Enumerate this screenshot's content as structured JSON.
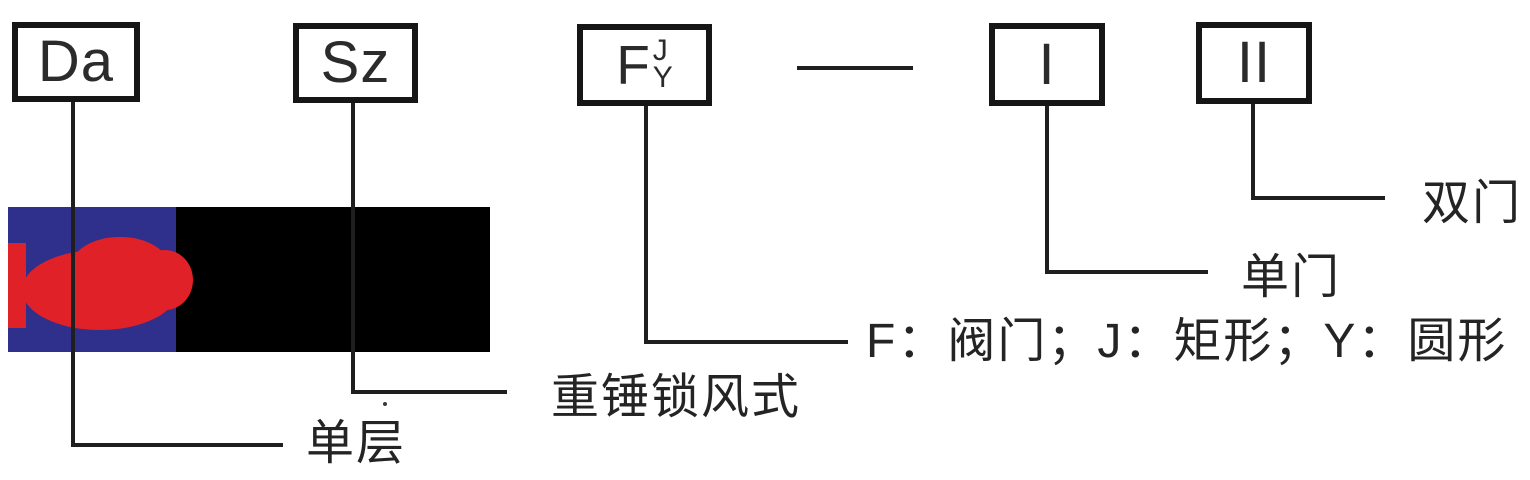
{
  "diagram": {
    "kind": "model-designation-diagram",
    "boxes": [
      {
        "id": "da",
        "code": "Da",
        "annotation": "单层"
      },
      {
        "id": "sz",
        "code": "Sz",
        "annotation": "重锤锁风式"
      },
      {
        "id": "fjy",
        "code": "F",
        "sup": "J",
        "sub": "Y",
        "annotation": "F：阀门；J：矩形；Y：圆形"
      },
      {
        "id": "one",
        "code": "I",
        "annotation": "单门"
      },
      {
        "id": "two",
        "code": "II",
        "annotation": "双门"
      }
    ],
    "colors": {
      "ink": "#1f1f1f",
      "logo_blue": "#2f2f8c",
      "logo_red": "#e02127",
      "logo_black": "#000000"
    }
  }
}
